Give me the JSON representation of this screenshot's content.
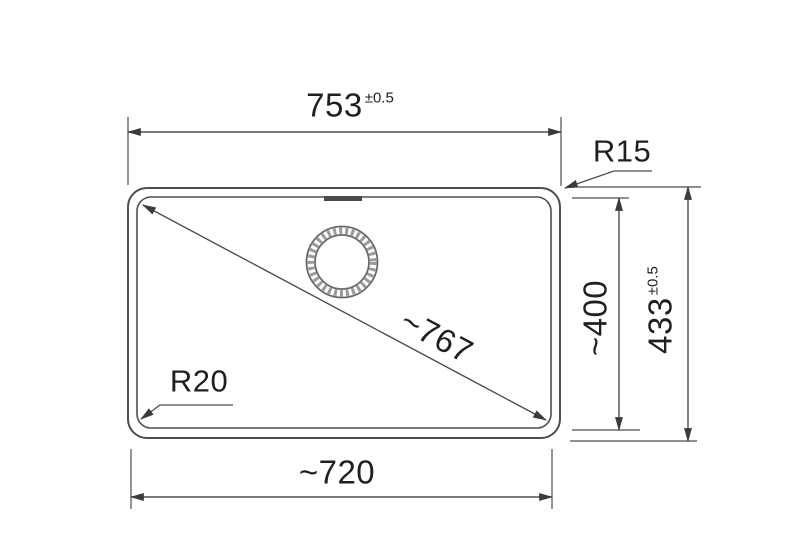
{
  "drawing": {
    "type": "sink-installation-dimension-drawing",
    "colors": {
      "background": "#ffffff",
      "line": "#4e4e4e",
      "text": "#1f1f1f",
      "arrow": "#3b3b3b",
      "drain_hatch": "#9a9a9a"
    },
    "dimensions": {
      "top_width": {
        "value": "753",
        "tolerance": "±0.5"
      },
      "corner_radius_top_right": {
        "label": "R15"
      },
      "inner_height": {
        "value": "~400"
      },
      "outer_height": {
        "value": "433",
        "tolerance": "±0.5"
      },
      "diagonal": {
        "value": "~767"
      },
      "corner_radius_bottom_left": {
        "label": "R20"
      },
      "bottom_width": {
        "value": "~720"
      }
    }
  }
}
